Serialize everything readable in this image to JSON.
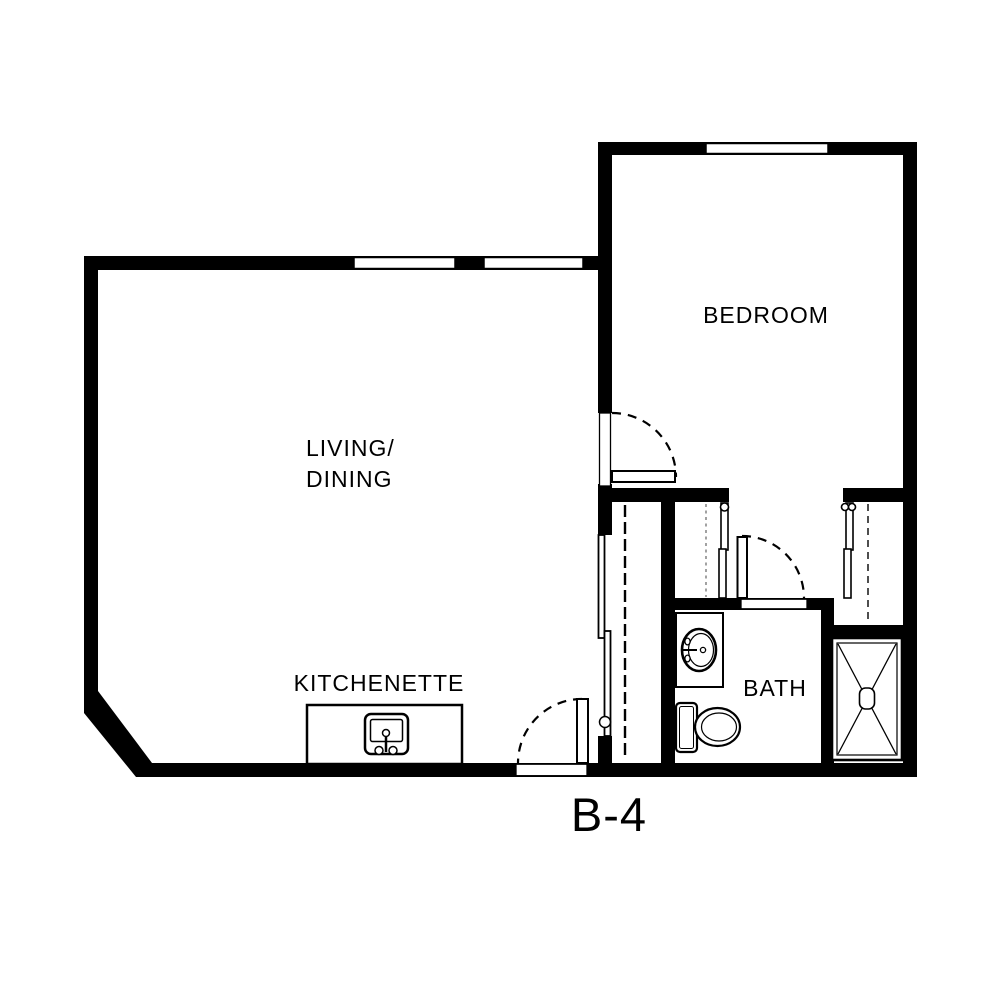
{
  "plan": {
    "title": "B-4",
    "rooms": {
      "living": {
        "label_line1": "LIVING/",
        "label_line2": "DINING"
      },
      "bedroom": {
        "label": "BEDROOM"
      },
      "kitchenette": {
        "label": "KITCHENETTE"
      },
      "bath": {
        "label": "BATH"
      }
    },
    "fixtures": [
      "kitchen-sink",
      "vanity-sink",
      "toilet",
      "shower"
    ],
    "doors": [
      "entry-door",
      "bedroom-door",
      "bath-door",
      "sliding-closet-doors",
      "vestibule-closet-door-left",
      "vestibule-closet-door-right"
    ],
    "colors": {
      "wall": "#000000",
      "background": "#ffffff",
      "closet_dash_gray": "#8a8a8a"
    }
  }
}
